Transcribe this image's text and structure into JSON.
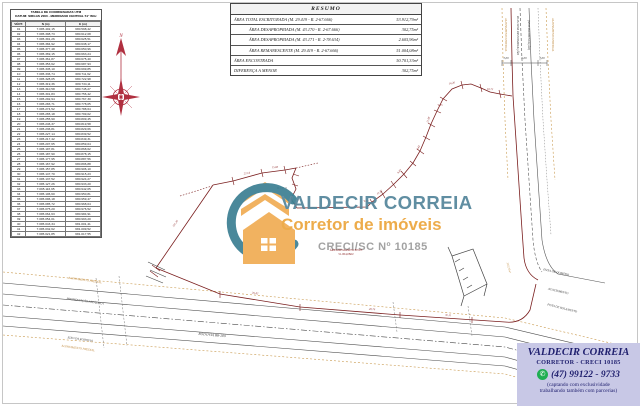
{
  "colors": {
    "boundary_red": "#7a1e1e",
    "label_orange": "#c08a3e",
    "logo_teal": "#55869b",
    "logo_orange": "#eca63e",
    "creci_gray": "#9b9b9b",
    "footer_navy": "#1f1f6e",
    "footer_bg": "#c8c8e6",
    "whatsapp_green": "#1fae52"
  },
  "coord_table": {
    "title_line1": "TABELA DE COORDENADAS UTM",
    "title_line2": "DATUM: SIRGAS 2000 - MERIDIANO CENTRAL 51° WGr",
    "headers": [
      "VÉRT.",
      "N (m)",
      "E (m)"
    ],
    "rows": [
      [
        "01",
        "7.095.402,15",
        "680.598,42"
      ],
      [
        "02",
        "7.095.398,73",
        "680.612,08"
      ],
      [
        "03",
        "7.095.391,26",
        "680.625,51"
      ],
      [
        "04",
        "7.095.384,92",
        "680.638,17"
      ],
      [
        "05",
        "7.095.377,48",
        "680.650,96"
      ],
      [
        "06",
        "7.095.369,15",
        "680.663,24"
      ],
      [
        "07",
        "7.095.361,87",
        "680.675,40"
      ],
      [
        "08",
        "7.095.353,62",
        "680.687,93"
      ],
      [
        "09",
        "7.095.345,10",
        "680.699,85"
      ],
      [
        "10",
        "7.095.336,74",
        "680.711,62"
      ],
      [
        "11",
        "7.095.328,05",
        "680.722,98"
      ],
      [
        "12",
        "7.095.319,36",
        "680.734,11"
      ],
      [
        "13",
        "7.095.310,58",
        "680.745,27"
      ],
      [
        "14",
        "7.095.301,83",
        "680.756,42"
      ],
      [
        "15",
        "7.095.292,94",
        "680.767,30"
      ],
      [
        "16",
        "7.095.283,71",
        "680.778,05"
      ],
      [
        "17",
        "7.095.274,52",
        "680.788,64"
      ],
      [
        "18",
        "7.095.265,18",
        "680.799,02"
      ],
      [
        "19",
        "7.095.255,90",
        "680.809,45"
      ],
      [
        "20",
        "7.095.246,37",
        "680.819,58"
      ],
      [
        "21",
        "7.095.236,81",
        "680.829,66"
      ],
      [
        "22",
        "7.095.227,14",
        "680.839,52"
      ],
      [
        "23",
        "7.095.217,42",
        "680.849,31"
      ],
      [
        "24",
        "7.095.207,65",
        "680.859,04"
      ],
      [
        "25",
        "7.095.197,81",
        "680.868,62"
      ],
      [
        "26",
        "7.095.187,90",
        "680.878,15"
      ],
      [
        "27",
        "7.095.177,95",
        "680.887,56"
      ],
      [
        "28",
        "7.095.167,92",
        "680.896,88"
      ],
      [
        "29",
        "7.095.157,85",
        "680.906,10"
      ],
      [
        "30",
        "7.095.147,70",
        "680.915,23"
      ],
      [
        "31",
        "7.095.137,52",
        "680.924,27"
      ],
      [
        "32",
        "7.095.127,26",
        "680.933,20"
      ],
      [
        "33",
        "7.095.116,95",
        "680.942,05"
      ],
      [
        "34",
        "7.095.106,60",
        "680.950,81"
      ],
      [
        "35",
        "7.095.096,18",
        "680.959,47"
      ],
      [
        "36",
        "7.095.085,72",
        "680.968,04"
      ],
      [
        "37",
        "7.095.075,20",
        "680.976,52"
      ],
      [
        "38",
        "7.095.064,63",
        "680.984,91"
      ],
      [
        "39",
        "7.095.054,01",
        "680.993,20"
      ],
      [
        "40",
        "7.095.043,34",
        "681.001,41"
      ],
      [
        "41",
        "7.095.032,62",
        "681.009,52"
      ],
      [
        "42",
        "7.095.021,85",
        "681.017,55"
      ]
    ]
  },
  "resumo": {
    "title": "RESUMO",
    "rows": [
      {
        "label": "ÁREA TOTAL ESCRITURADA  (M. 29.419 - R. 2-67.666)",
        "value": "53.912,79m²",
        "indent": false
      },
      {
        "label": "ÁREA DESAPROPRIADA  (M. 43.170 - R. 2-67.666)",
        "value": "302,75m²",
        "indent": true
      },
      {
        "label": "ÁREA DESAPROPRIADA  (M. 43.171 - R. 2-78.634)",
        "value": "2.605,96m²",
        "indent": true
      },
      {
        "label": "ÁREA REMANESCENTE  (M. 29.419 - R. 2-67.666)",
        "value": "51.004,08m²",
        "indent": true
      },
      {
        "label": "ÁREA ENCONTRADA",
        "value": "50.701,33m²",
        "indent": false
      },
      {
        "label": "DIFERENÇA A MENOR",
        "value": "302,75m²",
        "indent": false
      }
    ]
  },
  "watermark": {
    "name": "VALDECIR CORREIA",
    "tagline": "Corretor de imóveis",
    "creci": "CRECI/SC Nº 10185",
    "house_icon": "house-swoosh-logo"
  },
  "area_note": {
    "line1": "ÁREA REMANESCENTE",
    "line2": "51.004,08m²"
  },
  "footer": {
    "name": "VALDECIR CORREIA",
    "subtitle": "CORRETOR - CRECI 10185",
    "whatsapp_icon": "whatsapp-phone-icon",
    "phone": "(47) 99122 - 9733",
    "note_line1": "(captando com exclusividade",
    "note_line2": "trabalhando também com parcerias)"
  },
  "plan": {
    "compass_label": "N",
    "labels": [
      {
        "t": "N",
        "x": 121,
        "y": 37,
        "s": 5,
        "c": "#b03040",
        "a": "middle"
      },
      {
        "t": "ALINHAMENTO PREDIAL",
        "x": 505,
        "y": 18,
        "r": 90,
        "c": "#c08a3e",
        "s": 3,
        "a": "start"
      },
      {
        "t": "RUA SEM DENOMINAÇÃO",
        "x": 517,
        "y": 16,
        "r": 90,
        "c": "#3d3d3d",
        "s": 3.4,
        "a": "start"
      },
      {
        "t": "(SEM PAVIMENTAÇÃO)",
        "x": 528,
        "y": 20,
        "r": 90,
        "c": "#3d3d3d",
        "s": 3,
        "a": "start"
      },
      {
        "t": "ALINHAMENTO PREDIAL",
        "x": 552,
        "y": 18,
        "r": 90,
        "c": "#c08a3e",
        "s": 3,
        "a": "start"
      },
      {
        "t": "3,00",
        "x": 506,
        "y": 59,
        "s": 3,
        "c": "#3d3d3d"
      },
      {
        "t": "6,00",
        "x": 524,
        "y": 59,
        "s": 3,
        "c": "#3d3d3d"
      },
      {
        "t": "3,00",
        "x": 542,
        "y": 59,
        "s": 3,
        "c": "#3d3d3d"
      },
      {
        "t": "ALINHAMENTO PREDIAL",
        "x": 85,
        "y": 281,
        "r": 8,
        "c": "#c08a3e",
        "s": 3
      },
      {
        "t": "PAVIMENTAÇÃO ASFÁLTICA",
        "x": 85,
        "y": 302,
        "r": 8,
        "c": "#3d3d3d",
        "s": 3
      },
      {
        "t": "EIXO DA RODOVIA",
        "x": 80,
        "y": 340,
        "r": 8,
        "c": "#3d3d3d",
        "s": 3
      },
      {
        "t": "ALINHAMENTO PREDIAL",
        "x": 78,
        "y": 349,
        "r": 8,
        "c": "#c08a3e",
        "s": 3
      },
      {
        "t": "RODOVIA BR-280",
        "x": 212,
        "y": 336,
        "r": 5,
        "c": "#3d3d3d",
        "s": 3.6
      },
      {
        "t": "FAIXA DE DOMÍNIO",
        "x": 556,
        "y": 273,
        "r": 12,
        "c": "#3d3d3d",
        "s": 3
      },
      {
        "t": "ACOSTAMENTO",
        "x": 558,
        "y": 292,
        "r": 13,
        "c": "#3d3d3d",
        "s": 3
      },
      {
        "t": "PISTA DE ROLAMENTO",
        "x": 562,
        "y": 309,
        "r": 14,
        "c": "#3d3d3d",
        "s": 3
      },
      {
        "t": "101,35",
        "x": 176,
        "y": 224,
        "r": -56,
        "c": "#8a2525",
        "s": 2.8
      },
      {
        "t": "22,14",
        "x": 247,
        "y": 174,
        "r": -10,
        "c": "#8a2525",
        "s": 2.8
      },
      {
        "t": "15,60",
        "x": 275,
        "y": 168,
        "r": -4,
        "c": "#8a2525",
        "s": 2.8
      },
      {
        "t": "12,35",
        "x": 380,
        "y": 193,
        "r": -40,
        "c": "#8a2525",
        "s": 2.8
      },
      {
        "t": "9,87",
        "x": 400,
        "y": 172,
        "r": -48,
        "c": "#8a2525",
        "s": 2.8
      },
      {
        "t": "8,42",
        "x": 419,
        "y": 148,
        "r": -62,
        "c": "#8a2525",
        "s": 2.8
      },
      {
        "t": "11,08",
        "x": 429,
        "y": 120,
        "r": -72,
        "c": "#8a2525",
        "s": 2.8
      },
      {
        "t": "14,20",
        "x": 452,
        "y": 84,
        "r": -12,
        "c": "#8a2525",
        "s": 2.8
      },
      {
        "t": "18,75",
        "x": 490,
        "y": 90,
        "r": 4,
        "c": "#8a2525",
        "s": 2.8
      },
      {
        "t": "35,42",
        "x": 255,
        "y": 294,
        "r": 7,
        "c": "#8a2525",
        "s": 2.8
      },
      {
        "t": "28,76",
        "x": 372,
        "y": 310,
        "r": 4,
        "c": "#8a2525",
        "s": 2.8
      },
      {
        "t": "30,11",
        "x": 448,
        "y": 316,
        "r": 3,
        "c": "#8a2525",
        "s": 2.8
      },
      {
        "t": "8,15",
        "x": 299,
        "y": 198,
        "r": -85,
        "c": "#8a2525",
        "s": 2.8
      },
      {
        "t": "V-08",
        "x": 366,
        "y": 202,
        "c": "#8a2525",
        "s": 2.6
      },
      {
        "t": "V-15",
        "x": 440,
        "y": 106,
        "c": "#8a2525",
        "s": 2.6
      },
      {
        "t": "M. CF. 11",
        "x": 282,
        "y": 189,
        "c": "#3d3d3d",
        "s": 2.6
      },
      {
        "t": "302,75m²",
        "x": 508,
        "y": 268,
        "r": 75,
        "c": "#c08a3e",
        "s": 2.8
      }
    ]
  }
}
